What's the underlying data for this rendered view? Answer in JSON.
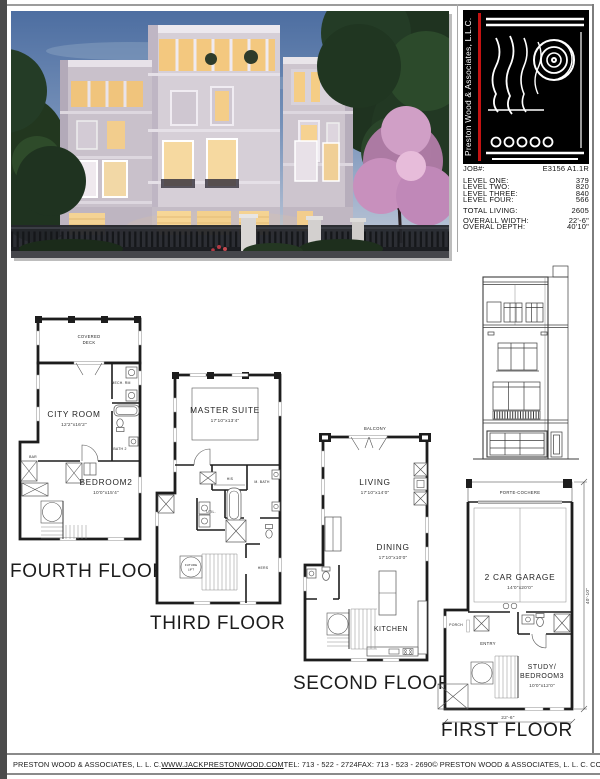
{
  "colors": {
    "logo_red": "#c41212",
    "wall": "#1d1d1d",
    "page_edge": "#4b4b4b"
  },
  "title_block": {
    "company_vertical": "Preston Wood & Associates, L.L.C.",
    "rows": [
      {
        "label": "JOB#:",
        "value": "E3156 A1.1R"
      },
      {
        "label": "LEVEL ONE:",
        "value": "379"
      },
      {
        "label": "LEVEL TWO:",
        "value": "820"
      },
      {
        "label": "LEVEL THREE:",
        "value": "840"
      },
      {
        "label": "LEVEL FOUR:",
        "value": "566"
      },
      {
        "label": "TOTAL LIVING:",
        "value": "2605"
      },
      {
        "label": "OVERALL WIDTH:",
        "value": "22'-6\""
      },
      {
        "label": "OVERAL DEPTH:",
        "value": "40'10\""
      }
    ]
  },
  "plans": {
    "fourth": {
      "title": "FOURTH FLOOR",
      "deck_line1": "COVERED",
      "deck_line2": "DECK",
      "city_room": "CITY ROOM",
      "city_room_dim": "12'2\"x16'2\"",
      "mech": "MECH. RM",
      "bath": "BATH 2",
      "bar": "BAR",
      "bedroom": "BEDROOM2",
      "bedroom_dim": "10'0\"x15'4\""
    },
    "third": {
      "title": "THIRD FLOOR",
      "master": "MASTER SUITE",
      "master_dim": "17'10\"x13'4\"",
      "his": "HIS",
      "mbath": "M. BATH",
      "util": "UTIL.",
      "lift_line1": "FUTURE",
      "lift_line2": "LIFT",
      "hers": "HERS"
    },
    "second": {
      "title": "SECOND FLOOR",
      "balcony": "BALCONY",
      "living": "LIVING",
      "living_dim": "17'10\"x14'0\"",
      "dining": "DINING",
      "dining_dim": "17'10\"x10'0\"",
      "kitchen": "KITCHEN"
    },
    "first": {
      "title": "FIRST FLOOR",
      "porte": "PORTE-COCHERE",
      "garage": "2 CAR GARAGE",
      "garage_dim": "14'0\"x20'0\"",
      "porch": "PORCH",
      "entry": "ENTRY",
      "study_line1": "STUDY/",
      "study_line2": "BEDROOM3",
      "study_dim": "10'0\"x12'0\"",
      "width_dim": "22'-6\"",
      "depth_dim": "40'-10\""
    }
  },
  "footer": {
    "company": "PRESTON WOOD & ASSOCIATES, L. L. C.",
    "website": "WWW.JACKPRESTONWOOD.COM",
    "tel": "TEL:  713 - 522 - 2724",
    "fax": "FAX:  713 - 523 - 2690",
    "copyright": "© PRESTON WOOD & ASSOCIATES, L. L. C.  COPYRIGHT"
  }
}
